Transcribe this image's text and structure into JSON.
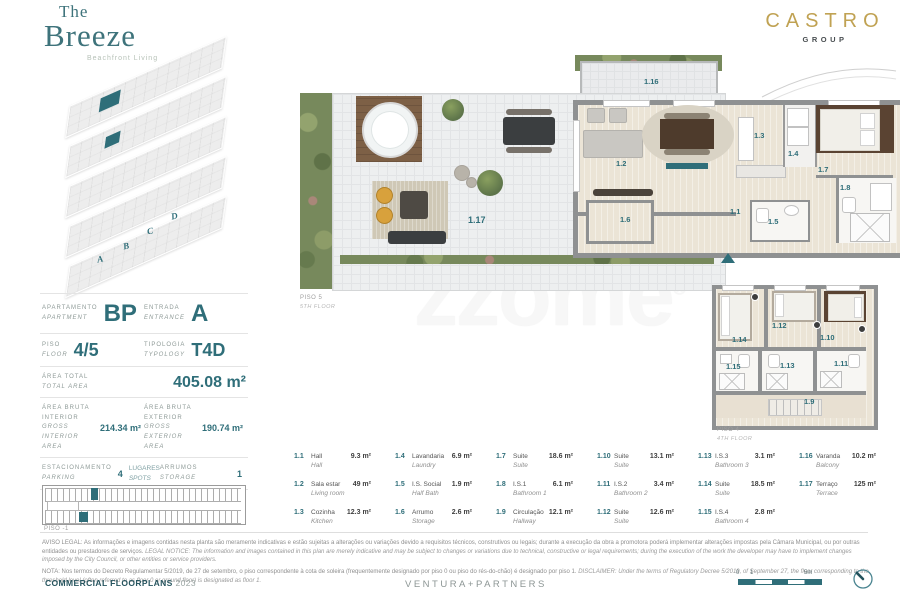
{
  "brand": {
    "the": "The",
    "breeze": "Breeze",
    "tagline": "Beachfront Living",
    "group_name": "CASTRO",
    "group_sub": "GROUP"
  },
  "colors": {
    "accent_teal": "#2f6e79",
    "brand_gold": "#c0a253",
    "wall_gray": "#8f9192"
  },
  "building": {
    "entrances": [
      "A",
      "B",
      "C",
      "D"
    ]
  },
  "info": {
    "apartment": {
      "label_pt": "APARTAMENTO",
      "label_en": "APARTMENT",
      "value": "BP"
    },
    "entrance": {
      "label_pt": "ENTRADA",
      "label_en": "ENTRANCE",
      "value": "A"
    },
    "floor": {
      "label_pt": "PISO",
      "label_en": "FLOOR",
      "value": "4/5"
    },
    "typology": {
      "label_pt": "TIPOLOGIA",
      "label_en": "TYPOLOGY",
      "value": "T4D"
    },
    "total_area": {
      "label_pt": "ÁREA TOTAL",
      "label_en": "TOTAL AREA",
      "value": "405.08 m²"
    },
    "gross_interior": {
      "label_pt": "ÁREA BRUTA INTERIOR",
      "label_en": "GROSS INTERIOR AREA",
      "value": "214.34 m²"
    },
    "gross_exterior": {
      "label_pt": "ÁREA BRUTA EXTERIOR",
      "label_en": "GROSS EXTERIOR AREA",
      "value": "190.74 m²"
    },
    "parking": {
      "label_pt": "ESTACIONAMENTO",
      "label_en": "PARKING",
      "value": "4",
      "unit_pt": "LUGARES",
      "unit_en": "SPOTS"
    },
    "storage": {
      "label_pt": "ARRUMOS",
      "label_en": "STORAGE",
      "value": "1"
    }
  },
  "plans": {
    "floor5": {
      "label": "PISO 5",
      "sublabel": "5TH FLOOR"
    },
    "floor4": {
      "label": "PISO 4",
      "sublabel": "4TH FLOOR"
    },
    "garage": {
      "label": "PISO -1"
    }
  },
  "room_labels": {
    "hall": "1.1",
    "living": "1.2",
    "kitchen": "1.3",
    "laundry": "1.4",
    "halfbath": "1.5",
    "storage": "1.6",
    "suite1": "1.7",
    "bath1": "1.8",
    "hallway": "1.9",
    "suite2": "1.10",
    "bath2": "1.11",
    "suite3": "1.12",
    "bath3": "1.13",
    "suite4": "1.14",
    "bath4": "1.15",
    "balcony": "1.16",
    "terrace": "1.17"
  },
  "legend": {
    "items": [
      {
        "num": "1.1",
        "pt": "Hall",
        "en": "Hall",
        "area": "9.3 m²"
      },
      {
        "num": "1.2",
        "pt": "Sala estar",
        "en": "Living room",
        "area": "49 m²"
      },
      {
        "num": "1.3",
        "pt": "Cozinha",
        "en": "Kitchen",
        "area": "12.3 m²"
      },
      {
        "num": "1.4",
        "pt": "Lavandaria",
        "en": "Laundry",
        "area": "6.9 m²"
      },
      {
        "num": "1.5",
        "pt": "I.S. Social",
        "en": "Half Bath",
        "area": "1.9 m²"
      },
      {
        "num": "1.6",
        "pt": "Arrumo",
        "en": "Storage",
        "area": "2.6 m²"
      },
      {
        "num": "1.7",
        "pt": "Suite",
        "en": "Suite",
        "area": "18.6 m²"
      },
      {
        "num": "1.8",
        "pt": "I.S.1",
        "en": "Bathroom 1",
        "area": "6.1 m²"
      },
      {
        "num": "1.9",
        "pt": "Circulação",
        "en": "Hallway",
        "area": "12.1 m²"
      },
      {
        "num": "1.10",
        "pt": "Suite",
        "en": "Suite",
        "area": "13.1 m²"
      },
      {
        "num": "1.11",
        "pt": "I.S.2",
        "en": "Bathroom 2",
        "area": "3.4 m²"
      },
      {
        "num": "1.12",
        "pt": "Suite",
        "en": "Suite",
        "area": "12.6 m²"
      },
      {
        "num": "1.13",
        "pt": "I.S.3",
        "en": "Bathroom 3",
        "area": "3.1 m²"
      },
      {
        "num": "1.14",
        "pt": "Suite",
        "en": "Suite",
        "area": "18.5 m²"
      },
      {
        "num": "1.15",
        "pt": "I.S.4",
        "en": "Bathroom 4",
        "area": "2.8 m²"
      },
      {
        "num": "1.16",
        "pt": "Varanda",
        "en": "Balcony",
        "area": "10.2 m²"
      },
      {
        "num": "1.17",
        "pt": "Terraço",
        "en": "Terrace",
        "area": "125 m²"
      }
    ]
  },
  "watermark": {
    "text": "zzome",
    "reg": "®"
  },
  "disclaimer": {
    "p1_pt": "AVISO LEGAL: As informações e imagens contidas nesta planta são meramente indicativas e estão sujeitas a alterações ou variações devido a requisitos técnicos, construtivos ou legais; durante a execução da obra a promotora poderá implementar alterações impostas pela Câmara Municipal, ou por outras entidades ou prestadores de serviços.",
    "p1_en": "LEGAL NOTICE: The information and images contained in this plan are merely indicative and may be subject to changes or variations due to technical, constructive or legal requirements; during the execution of the work the developer may have to implement changes imposed by the City Council, or other entities or service providers.",
    "p2_pt": "NOTA: Nos termos do Decreto Regulamentar 5/2019, de 27 de setembro, o piso correspondente à cota de soleira (frequentemente designado por piso 0 ou piso do rés-do-chão) é designado por piso 1.",
    "p2_en": "DISCLAIMER: Under the terms of Regulatory Decree 5/2019, of September 27, the floor corresponding to the threshold level (often referred to as floor 0 or ground floor) is designated as floor 1."
  },
  "footer": {
    "title": "COMMERCIAL FLOORPLANS",
    "year": "2023",
    "agency": "VENTURA+PARTNERS",
    "scale": {
      "zero": "0",
      "one": "1",
      "five": "5m"
    }
  }
}
